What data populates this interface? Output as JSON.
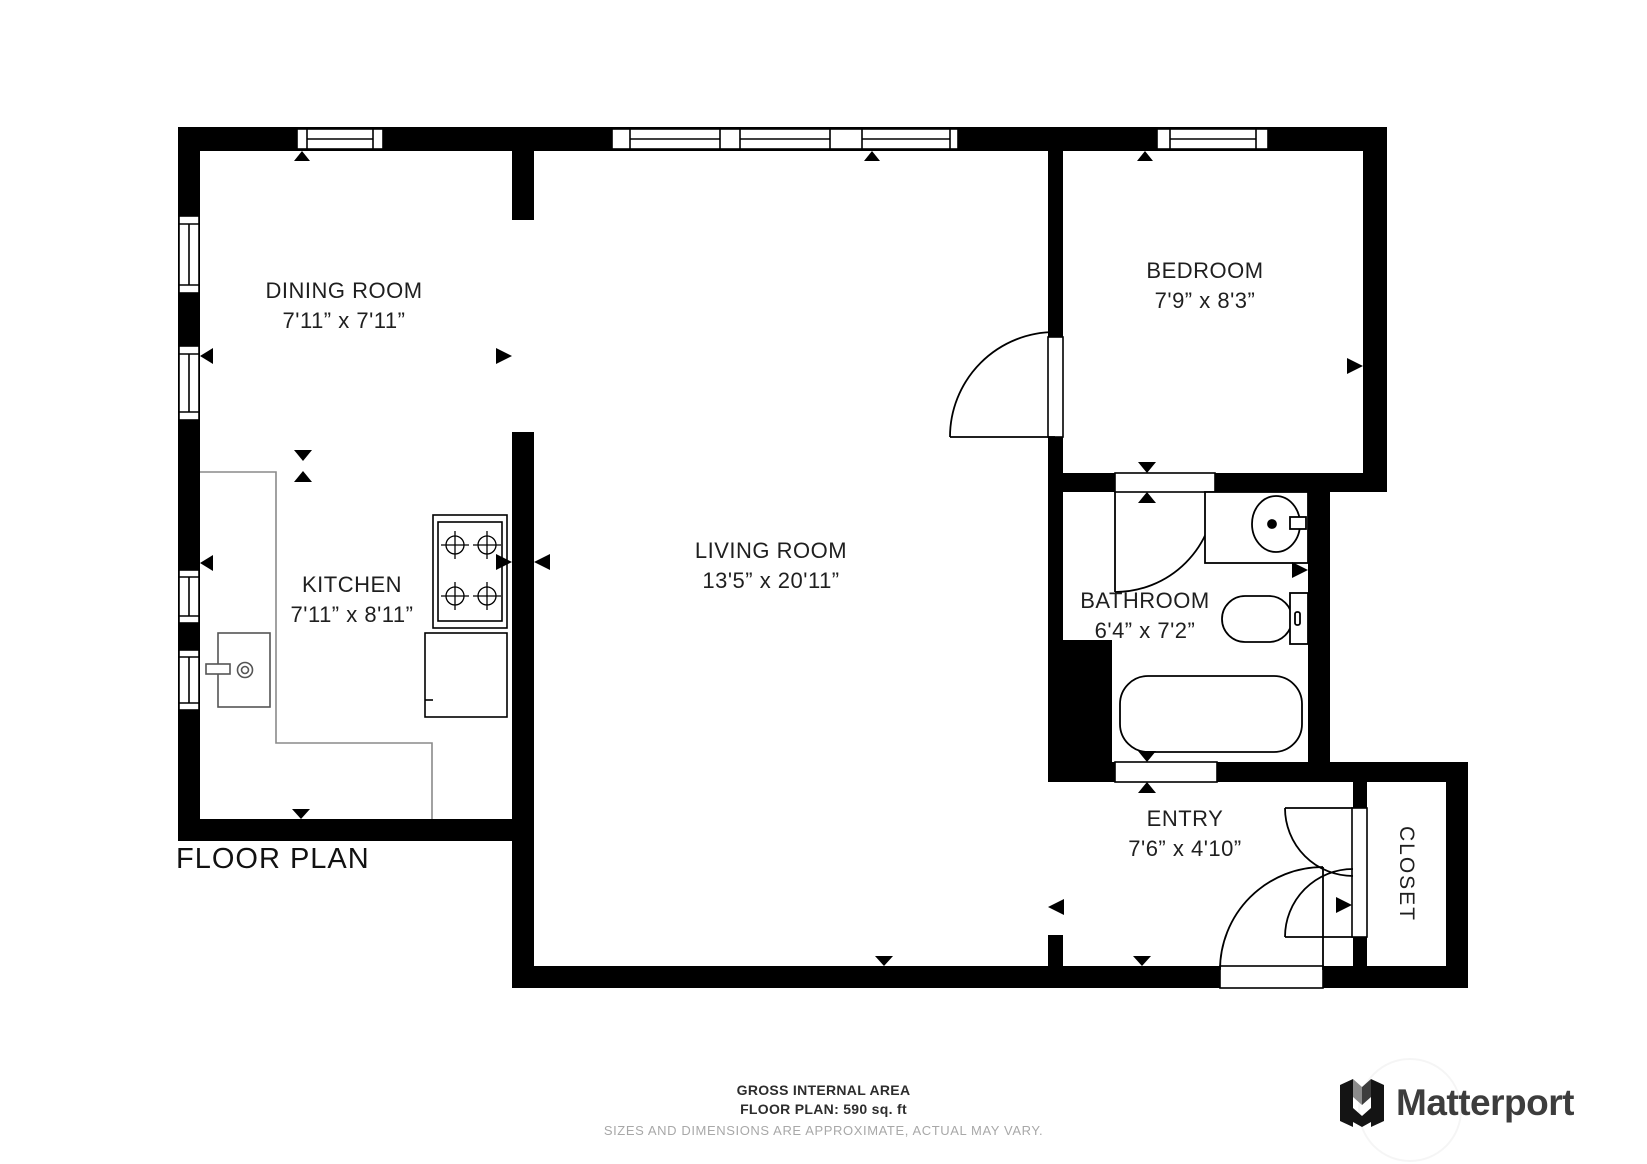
{
  "title": "FLOOR PLAN",
  "rooms": {
    "dining": {
      "name": "DINING ROOM",
      "dims": "7'11” x 7'11”"
    },
    "kitchen": {
      "name": "KITCHEN",
      "dims": "7'11” x 8'11”"
    },
    "living": {
      "name": "LIVING ROOM",
      "dims": "13'5” x 20'11”"
    },
    "bedroom": {
      "name": "BEDROOM",
      "dims": "7'9” x 8'3”"
    },
    "bathroom": {
      "name": "BATHROOM",
      "dims": "6'4” x 7'2”"
    },
    "entry": {
      "name": "ENTRY",
      "dims": "7'6” x 4'10”"
    },
    "closet": {
      "name": "CLOSET"
    }
  },
  "footer": {
    "line1": "GROSS INTERNAL AREA",
    "line2": "FLOOR PLAN: 590 sq. ft",
    "line3": "SIZES AND DIMENSIONS ARE APPROXIMATE, ACTUAL MAY VARY."
  },
  "branding": {
    "logo_text": "Matterport"
  },
  "colors": {
    "wall": "#000000",
    "fixture_line": "#000000",
    "counter_line": "#8a8a8a",
    "footer_muted": "#a8a8a8",
    "logo_text": "#3d3d3d"
  }
}
